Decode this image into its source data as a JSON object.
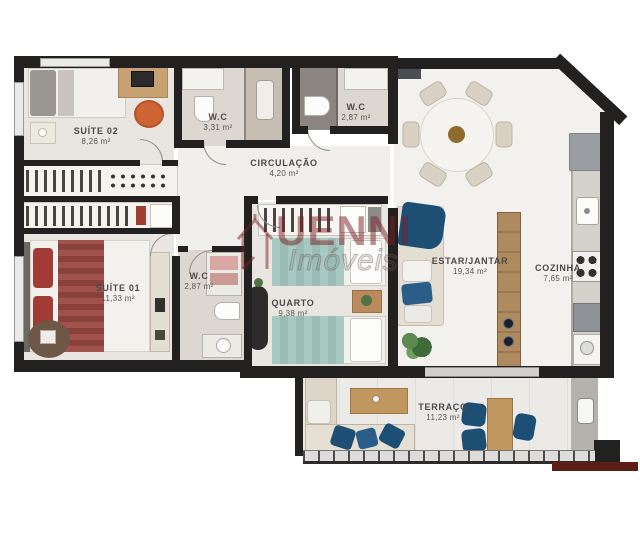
{
  "plan": {
    "title": "apartment-floor-plan",
    "watermark": {
      "brand": "UENNI",
      "sub": "Imóveis"
    },
    "rooms": [
      {
        "id": "suite-02",
        "name": "SUÍTE 02",
        "area": "8,26 m²"
      },
      {
        "id": "wc-top",
        "name": "W.C",
        "area": "3,31 m²"
      },
      {
        "id": "wc-right",
        "name": "W.C",
        "area": "2,87 m²"
      },
      {
        "id": "circulacao",
        "name": "CIRCULAÇÃO",
        "area": "4,20 m²"
      },
      {
        "id": "suite-01",
        "name": "SUÍTE 01",
        "area": "11,33 m²"
      },
      {
        "id": "wc-suite01",
        "name": "W.C",
        "area": "2,87 m²"
      },
      {
        "id": "quarto",
        "name": "QUARTO",
        "area": "9,38 m²"
      },
      {
        "id": "estar",
        "name": "ESTAR/JANTAR",
        "area": "19,34 m²"
      },
      {
        "id": "cozinha",
        "name": "COZINHA",
        "area": "7,65 m²"
      },
      {
        "id": "terraco",
        "name": "TERRAÇO",
        "area": "11,23 m²"
      }
    ],
    "colors": {
      "wall": "#23211f",
      "brand_maroon": "#7a1f26",
      "accent_blue": "#1d4e74",
      "teal_bed": "#a8c9c2",
      "wood": "#c09a68",
      "bedroom_floor": "#e9e6e1",
      "living_floor": "#f2f1ee",
      "maroon_strip": "#5c1f17"
    }
  }
}
